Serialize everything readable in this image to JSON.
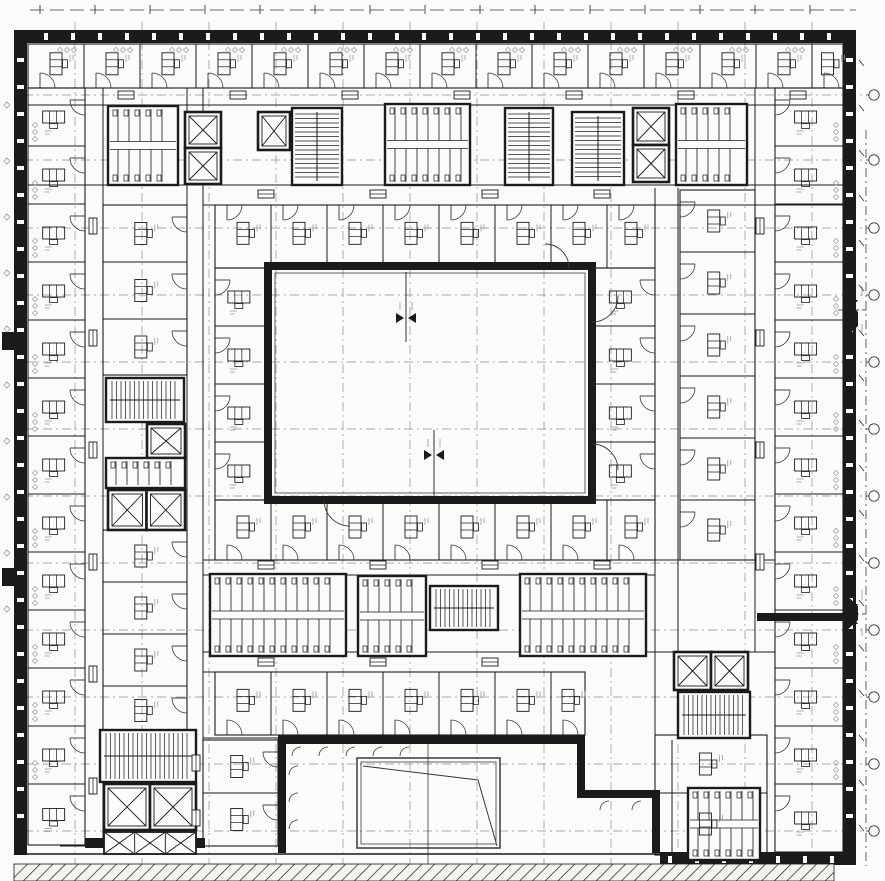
{
  "meta": {
    "label": "Scanned architectural floor plan of a courtyard office building",
    "canvas": {
      "w": 885,
      "h": 881
    }
  },
  "colors": {
    "paper": "#fbfbf9",
    "ink": "#1b1b1b",
    "soft": "#3a3a3a",
    "grid": "#8f8f8f",
    "micro": "#9a9a9a"
  },
  "grid": {
    "v": [
      75,
      142,
      209,
      276,
      343,
      410,
      477,
      544,
      611,
      678,
      745,
      812
    ],
    "h": [
      95,
      160,
      228,
      295,
      362,
      429,
      496,
      563,
      630,
      697,
      764,
      831
    ]
  },
  "exterior": {
    "top": {
      "x": 14,
      "y": 30,
      "w": 842,
      "h": 13
    },
    "left": {
      "x": 14,
      "y": 43,
      "w": 13,
      "h": 812
    },
    "right": {
      "x": 843,
      "y": 43,
      "w": 13,
      "h": 815
    },
    "bottom_right": {
      "x": 660,
      "y": 852,
      "w": 196,
      "h": 13
    },
    "bottom_line_y": 854,
    "bottom_line_x1": 14,
    "bottom_line_x2": 660,
    "slit_step": 27,
    "bumps": [
      [
        [
          843,
          298
        ],
        [
          858,
          312
        ],
        [
          858,
          326
        ],
        [
          843,
          340
        ]
      ],
      [
        [
          843,
          592
        ],
        [
          858,
          606
        ],
        [
          858,
          620
        ],
        [
          843,
          634
        ]
      ]
    ],
    "nubs": [
      {
        "x": 2,
        "y": 332,
        "w": 12,
        "h": 18
      },
      {
        "x": 2,
        "y": 568,
        "w": 12,
        "h": 18
      }
    ]
  },
  "central_courtyard": {
    "x": 268,
    "y": 266,
    "w": 324,
    "h": 234,
    "wall": 8
  },
  "lower_courtyard": {
    "walls": [
      {
        "x": 278,
        "y": 735,
        "w": 307,
        "h": 9
      },
      {
        "x": 278,
        "y": 735,
        "w": 8,
        "h": 118
      },
      {
        "x": 577,
        "y": 735,
        "w": 8,
        "h": 60
      },
      {
        "x": 577,
        "y": 790,
        "w": 83,
        "h": 8
      },
      {
        "x": 652,
        "y": 790,
        "w": 8,
        "h": 63
      }
    ],
    "arcs_top_x": [
      292,
      319,
      346,
      373,
      400
    ],
    "arcs_top_y": 747,
    "arcs_left_y": [
      766,
      793,
      820
    ],
    "arcs_left_x": 289,
    "arcs_ext": [
      [
        600,
        801
      ],
      [
        632,
        801
      ]
    ],
    "center_line": {
      "x": 428,
      "y1": 744,
      "y2": 866
    }
  },
  "skylight": {
    "x": 357,
    "y": 758,
    "w": 143,
    "h": 90,
    "inner": 4,
    "fold": [
      [
        363,
        766
      ],
      [
        478,
        780
      ],
      [
        497,
        846
      ]
    ]
  },
  "hatch_areas": [
    {
      "x": 14,
      "y": 864,
      "w": 820,
      "h": 17
    }
  ],
  "heavy_walls": [
    {
      "x": 757,
      "y": 613,
      "w": 86,
      "h": 8
    },
    {
      "x": 85,
      "y": 838,
      "w": 120,
      "h": 10
    }
  ],
  "lines": [
    [
      "v",
      85,
      88,
      845
    ],
    [
      "v",
      103,
      88,
      845
    ],
    [
      "v",
      187,
      88,
      738
    ],
    [
      "v",
      203,
      88,
      740
    ],
    [
      "v",
      655,
      188,
      790
    ],
    [
      "v",
      678,
      188,
      652
    ],
    [
      "v",
      755,
      88,
      652
    ],
    [
      "v",
      775,
      88,
      860
    ],
    [
      "v",
      672,
      740,
      860
    ],
    [
      "h",
      88,
      28,
      843
    ],
    [
      "h",
      105,
      28,
      843
    ],
    [
      "h",
      185,
      28,
      843
    ],
    [
      "h",
      205,
      203,
      843
    ],
    [
      "h",
      560,
      203,
      775
    ],
    [
      "h",
      575,
      203,
      655
    ],
    [
      "h",
      652,
      203,
      775
    ],
    [
      "h",
      672,
      203,
      585
    ],
    [
      "h",
      738,
      203,
      280
    ],
    [
      "h",
      846,
      60,
      203
    ]
  ],
  "bands": [
    {
      "name": "top-outer-rooms",
      "x": 28,
      "y": 44,
      "w": 815,
      "h": 44,
      "axis": "v",
      "step": 56,
      "desk": "v",
      "door": "bottom"
    },
    {
      "name": "top-inner-rooms",
      "x": 215,
      "y": 205,
      "w": 440,
      "h": 63,
      "axis": "v",
      "step": 56,
      "desk": "v",
      "door": "top"
    },
    {
      "name": "left-outer-rooms",
      "x": 28,
      "y": 88,
      "w": 57,
      "h": 757,
      "axis": "h",
      "step": 58,
      "desk": "h",
      "door": "right"
    },
    {
      "name": "right-outer-rooms",
      "x": 775,
      "y": 88,
      "w": 68,
      "h": 764,
      "axis": "h",
      "step": 58,
      "desk": "h",
      "door": "left"
    },
    {
      "name": "left-inner-rooms",
      "x": 215,
      "y": 268,
      "w": 53,
      "h": 232,
      "axis": "h",
      "step": 58,
      "desk": "h",
      "door": "left"
    },
    {
      "name": "right-inner-rooms",
      "x": 592,
      "y": 268,
      "w": 63,
      "h": 232,
      "axis": "h",
      "step": 58,
      "desk": "h",
      "door": "right"
    },
    {
      "name": "bottom-inner-rooms",
      "x": 215,
      "y": 500,
      "w": 440,
      "h": 60,
      "axis": "v",
      "step": 56,
      "desk": "v",
      "door": "bottom"
    },
    {
      "name": "bottom-band-rooms",
      "x": 215,
      "y": 672,
      "w": 370,
      "h": 63,
      "axis": "v",
      "step": 56,
      "desk": "v",
      "door": "bottom"
    },
    {
      "name": "right-mid-rooms",
      "x": 680,
      "y": 190,
      "w": 75,
      "h": 370,
      "axis": "h",
      "step": 62,
      "desk": "v",
      "door": "left"
    },
    {
      "name": "bottom-right-rooms",
      "x": 655,
      "y": 735,
      "w": 112,
      "h": 120,
      "axis": "h",
      "step": 58,
      "desk": "v",
      "door": "top"
    },
    {
      "name": "bottom-left-rooms",
      "x": 203,
      "y": 740,
      "w": 75,
      "h": 106,
      "axis": "h",
      "step": 53,
      "desk": "v",
      "door": "right"
    },
    {
      "name": "left-mid-rooms-a",
      "x": 103,
      "y": 205,
      "w": 84,
      "h": 170,
      "axis": "h",
      "step": 57,
      "desk": "v",
      "door": "right"
    },
    {
      "name": "left-mid-rooms-b",
      "x": 103,
      "y": 530,
      "w": 84,
      "h": 205,
      "axis": "h",
      "step": 52,
      "desk": "v",
      "door": "right"
    }
  ],
  "cores": [
    {
      "type": "wc",
      "x": 108,
      "y": 106,
      "w": 70,
      "h": 79
    },
    {
      "type": "elev2v",
      "x": 185,
      "y": 112,
      "w": 36,
      "h": 72
    },
    {
      "type": "elev1",
      "x": 258,
      "y": 112,
      "w": 32,
      "h": 38
    },
    {
      "type": "stair",
      "x": 292,
      "y": 108,
      "w": 50,
      "h": 77,
      "dir": "v"
    },
    {
      "type": "wc",
      "x": 385,
      "y": 104,
      "w": 85,
      "h": 81
    },
    {
      "type": "stair",
      "x": 505,
      "y": 108,
      "w": 48,
      "h": 77,
      "dir": "v"
    },
    {
      "type": "stair",
      "x": 572,
      "y": 112,
      "w": 52,
      "h": 73,
      "dir": "v"
    },
    {
      "type": "elev2v",
      "x": 633,
      "y": 108,
      "w": 36,
      "h": 74
    },
    {
      "type": "wc",
      "x": 676,
      "y": 104,
      "w": 71,
      "h": 81
    },
    {
      "type": "stair",
      "x": 106,
      "y": 378,
      "w": 78,
      "h": 44,
      "dir": "h"
    },
    {
      "type": "elev1",
      "x": 147,
      "y": 424,
      "w": 38,
      "h": 34
    },
    {
      "type": "wc",
      "x": 106,
      "y": 458,
      "w": 79,
      "h": 30
    },
    {
      "type": "elev2h",
      "x": 108,
      "y": 490,
      "w": 77,
      "h": 40
    },
    {
      "type": "wc",
      "x": 210,
      "y": 574,
      "w": 136,
      "h": 82
    },
    {
      "type": "wc",
      "x": 358,
      "y": 576,
      "w": 68,
      "h": 80
    },
    {
      "type": "stair",
      "x": 430,
      "y": 586,
      "w": 68,
      "h": 44,
      "dir": "h"
    },
    {
      "type": "wc",
      "x": 520,
      "y": 574,
      "w": 126,
      "h": 82
    },
    {
      "type": "elev2h",
      "x": 674,
      "y": 652,
      "w": 74,
      "h": 38
    },
    {
      "type": "stair",
      "x": 678,
      "y": 692,
      "w": 72,
      "h": 46,
      "dir": "h"
    },
    {
      "type": "wc",
      "x": 688,
      "y": 788,
      "w": 72,
      "h": 72
    },
    {
      "type": "stair",
      "x": 100,
      "y": 730,
      "w": 96,
      "h": 52,
      "dir": "h"
    },
    {
      "type": "elev2h",
      "x": 104,
      "y": 784,
      "w": 92,
      "h": 46
    },
    {
      "type": "shaft",
      "x": 104,
      "y": 832,
      "w": 92,
      "h": 22
    }
  ],
  "cabinet_rows": [
    {
      "o": "h",
      "y": 95,
      "xs": [
        118,
        230,
        342,
        454,
        566,
        678,
        790
      ]
    },
    {
      "o": "h",
      "y": 194,
      "xs": [
        258,
        370,
        482,
        594
      ]
    },
    {
      "o": "v",
      "x": 93,
      "ys": [
        218,
        330,
        442,
        554,
        666,
        778
      ]
    },
    {
      "o": "v",
      "x": 760,
      "ys": [
        218,
        330,
        442,
        554
      ]
    },
    {
      "o": "h",
      "y": 565,
      "xs": [
        258,
        370,
        482,
        594
      ]
    },
    {
      "o": "h",
      "y": 662,
      "xs": [
        258,
        370,
        482
      ]
    },
    {
      "o": "v",
      "x": 196,
      "ys": [
        755,
        810
      ]
    }
  ],
  "big_arcs": [
    {
      "hx": 592,
      "hy": 296,
      "r": 26,
      "sx": 1,
      "sy": 1
    },
    {
      "hx": 592,
      "hy": 470,
      "r": 26,
      "sx": 1,
      "sy": -1
    },
    {
      "hx": 350,
      "hy": 500,
      "r": 26,
      "sx": -1,
      "sy": 1
    },
    {
      "hx": 545,
      "hy": 268,
      "r": 24,
      "sx": 1,
      "sy": -1
    }
  ],
  "level_markers": {
    "plan": [
      {
        "cx": 406,
        "cy": 318,
        "l1": 272,
        "l2": 342
      },
      {
        "cx": 434,
        "cy": 455,
        "l1": 430,
        "l2": 500
      }
    ],
    "edge": [
      {
        "cx": 851,
        "cy": 310
      },
      {
        "cx": 851,
        "cy": 614
      }
    ]
  },
  "site": {
    "top_dash": {
      "y": 10,
      "x1": 30,
      "x2": 856
    },
    "right_dash": {
      "x": 866,
      "y1": 130,
      "y2": 866
    },
    "bubbles_x": 874,
    "tick_col_x": 859,
    "tick_row_y": 8
  },
  "glazing": {
    "top_y": 50,
    "top_x0": 60,
    "top_n": 14,
    "top_step": 56,
    "left_x": 35,
    "left_y0": 125,
    "left_n": 12,
    "left_step": 58,
    "right_x": 836,
    "right_y0": 125,
    "right_n": 12,
    "right_step": 58
  }
}
